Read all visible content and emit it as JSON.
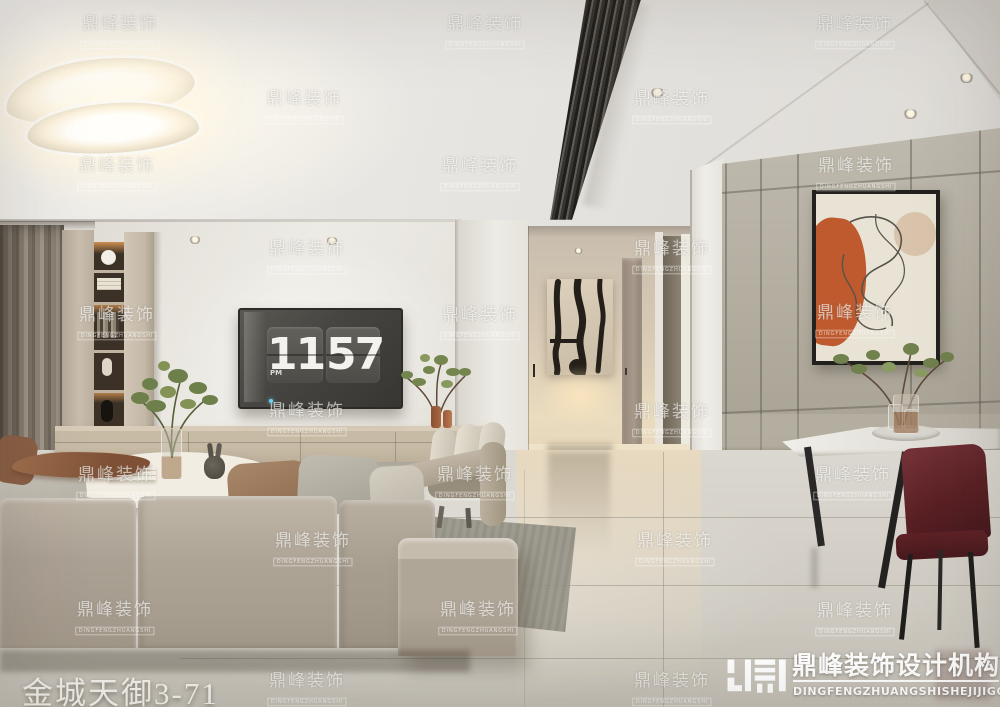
{
  "watermark": {
    "cn": "鼎峰装饰",
    "en": "DINGFENGZHUANGSHI",
    "positions": [
      [
        120,
        33
      ],
      [
        485,
        33
      ],
      [
        855,
        33
      ],
      [
        304,
        108
      ],
      [
        672,
        108
      ],
      [
        117,
        175
      ],
      [
        480,
        175
      ],
      [
        856,
        175
      ],
      [
        307,
        258
      ],
      [
        672,
        258
      ],
      [
        117,
        324
      ],
      [
        480,
        324
      ],
      [
        855,
        322
      ],
      [
        307,
        420
      ],
      [
        672,
        421
      ],
      [
        116,
        484
      ],
      [
        475,
        484
      ],
      [
        853,
        484
      ],
      [
        313,
        550
      ],
      [
        675,
        550
      ],
      [
        115,
        619
      ],
      [
        478,
        619
      ],
      [
        855,
        620
      ],
      [
        307,
        690
      ],
      [
        672,
        690
      ]
    ]
  },
  "caption": {
    "text": "金城天御3-71"
  },
  "logo": {
    "title": "鼎峰装饰设计机构",
    "subtitle": "DINGFENGZHUANGSHISHEJIJIGOU"
  },
  "tv_clock": {
    "hour": "11",
    "minute": "57",
    "meridiem": "PM"
  },
  "colors": {
    "art_orange": "#bf5a2e",
    "chair_maroon": "#5a2024",
    "panel_taupe": "#c7bbaa",
    "right_wall_gray": "#b3ada0",
    "floor_gray": "#d3cfc7",
    "hall_glow": "#ecd9b8",
    "tv_led_blue": "#6fd3f2"
  }
}
